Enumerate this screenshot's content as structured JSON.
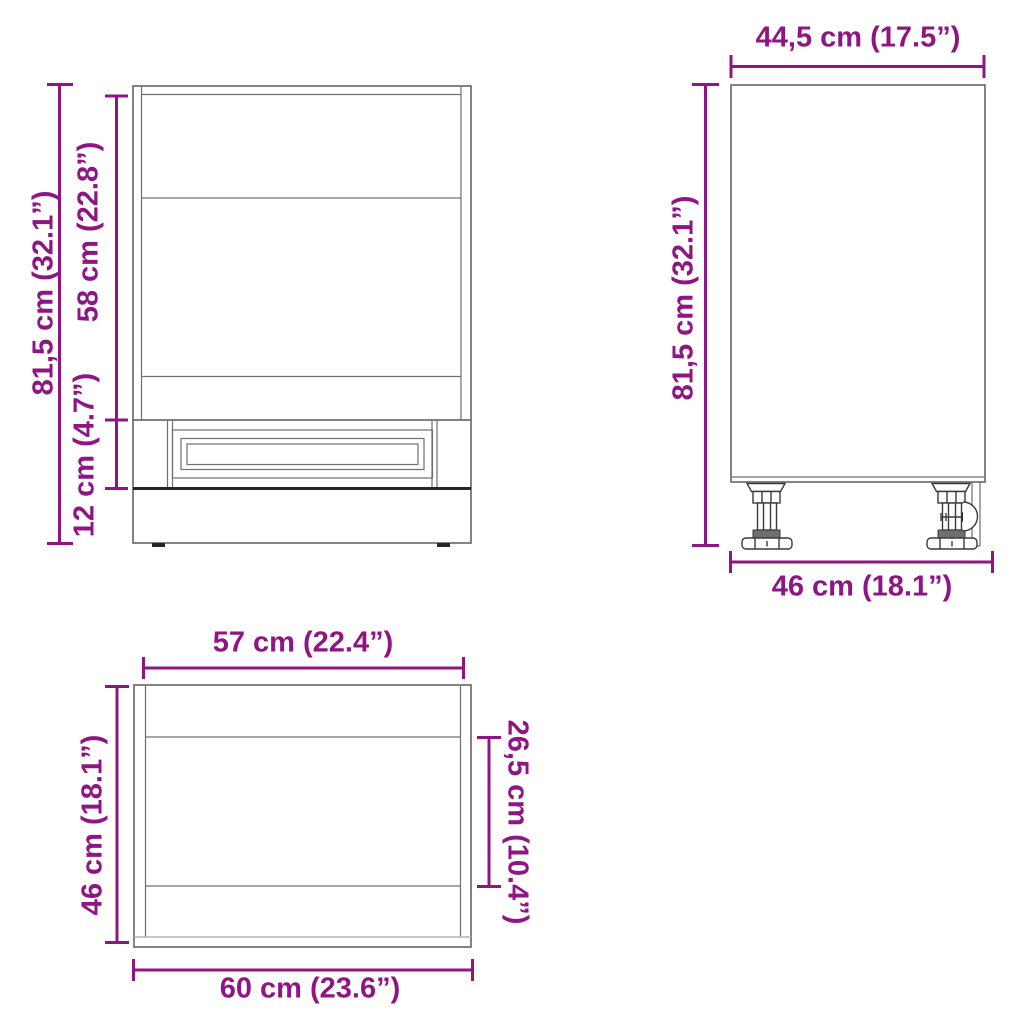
{
  "colors": {
    "accent": "#8e1583",
    "line": "#6f6f6f",
    "line-dark": "#262626",
    "line-light": "#b4b4b4"
  },
  "views": {
    "front": {
      "dims": {
        "overall_height": "81,5 cm (32.1”)",
        "niche_height": "58 cm (22.8”)",
        "drawer_height": "12 cm (4.7”)"
      }
    },
    "side": {
      "dims": {
        "top_depth": "44,5 cm (17.5”)",
        "overall_height": "81,5 cm (32.1”)",
        "bottom_depth": "46 cm (18.1”)"
      }
    },
    "top": {
      "dims": {
        "inner_width": "57 cm (22.4”)",
        "depth": "46 cm (18.1”)",
        "inner_depth": "26,5 cm (10.4”)",
        "overall_width": "60 cm (23.6”)"
      }
    }
  }
}
